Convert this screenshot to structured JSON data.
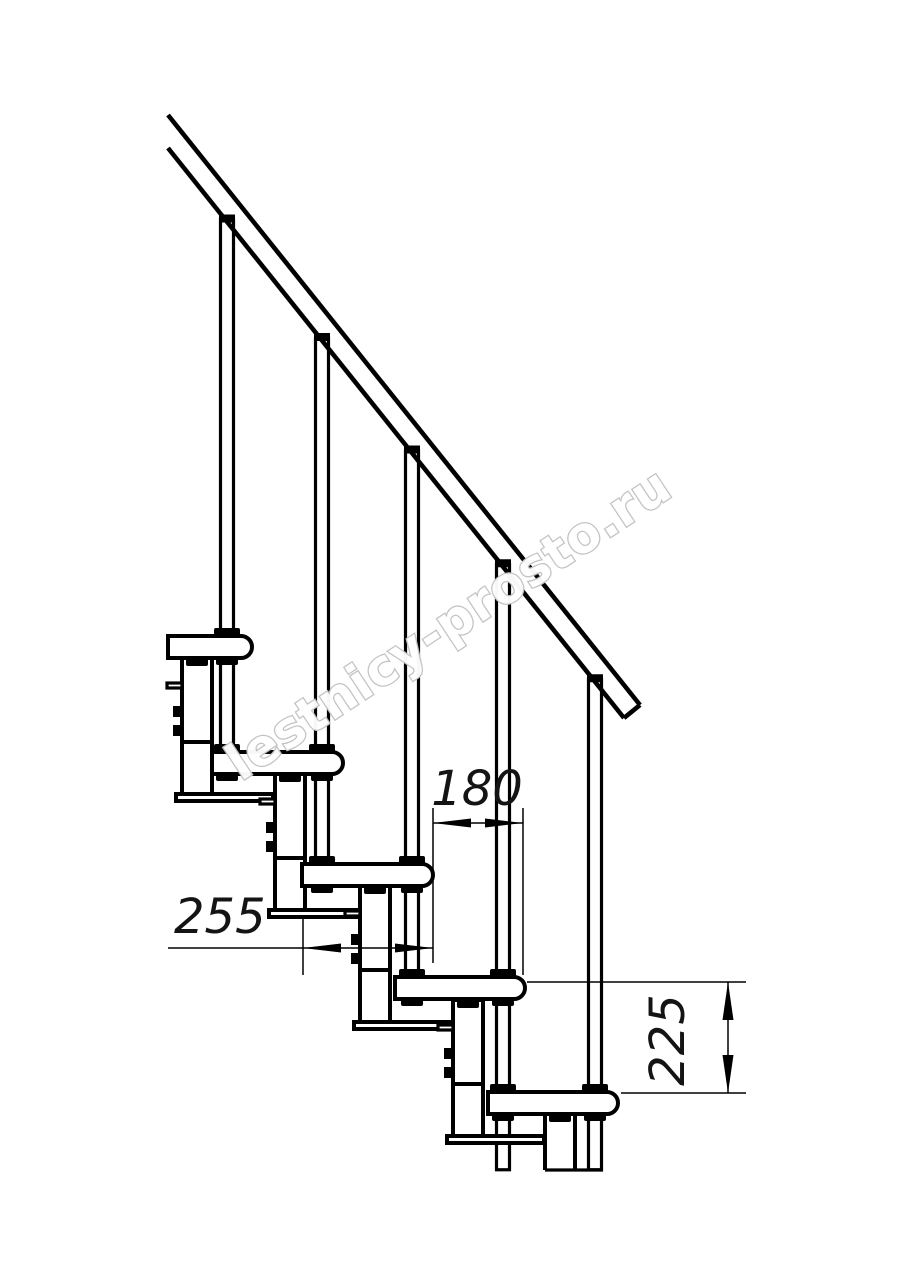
{
  "drawing": {
    "watermark": "lestnicy-prosto.ru",
    "dimensions": {
      "tread_depth": "255",
      "step_run": "180",
      "step_rise": "225"
    },
    "colors": {
      "line": "#000000",
      "background": "#ffffff",
      "watermark-outline": "#c3c3c3",
      "dim-text": "#141414"
    }
  }
}
